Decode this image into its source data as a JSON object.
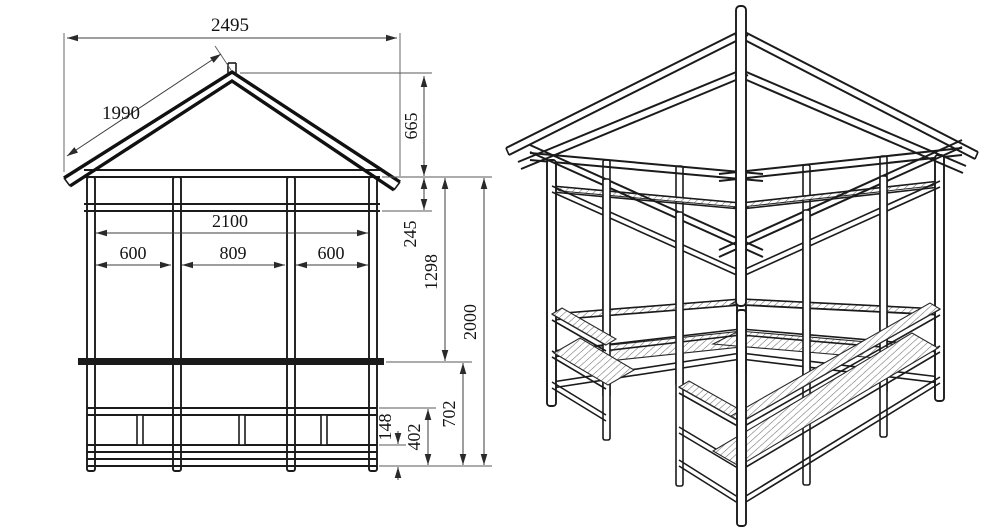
{
  "drawing": {
    "colors": {
      "line": "#1b1b1b",
      "dimension": "#3d3d3d",
      "background": "#ffffff",
      "hatch": "#6f6f6f"
    },
    "front_elevation": {
      "dims": {
        "roof_span": "2495",
        "rafter_length": "1990",
        "roof_rise": "665",
        "clear_width": "2100",
        "frieze_height": "245",
        "bay_left": "600",
        "bay_center": "809",
        "bay_right": "600",
        "plate_to_rail": "1298",
        "wall_height": "2000",
        "bottom_rail_height": "148",
        "mid_rail_height": "402",
        "rail_to_base": "702"
      }
    },
    "perspective_view": {
      "labels": []
    }
  }
}
